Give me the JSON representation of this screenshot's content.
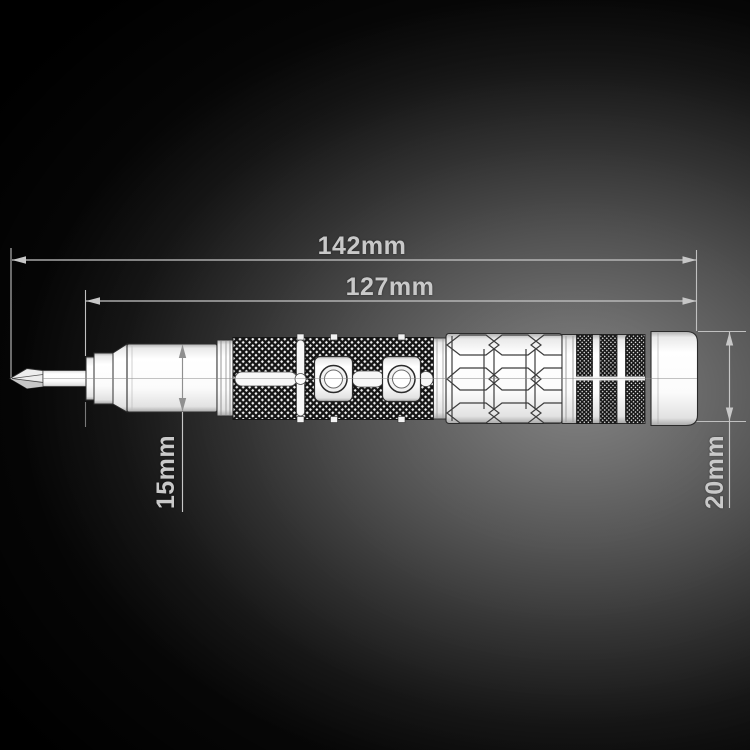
{
  "scene": {
    "background_base": "#000000",
    "spotlight_color": "#787878",
    "annotation_color": "#c7c7c7",
    "product_fill": "#ffffff"
  },
  "labels": {
    "total_length": "142mm",
    "body_length": "127mm",
    "front_barrel_diameter": "15mm",
    "handle_diameter": "20mm"
  }
}
